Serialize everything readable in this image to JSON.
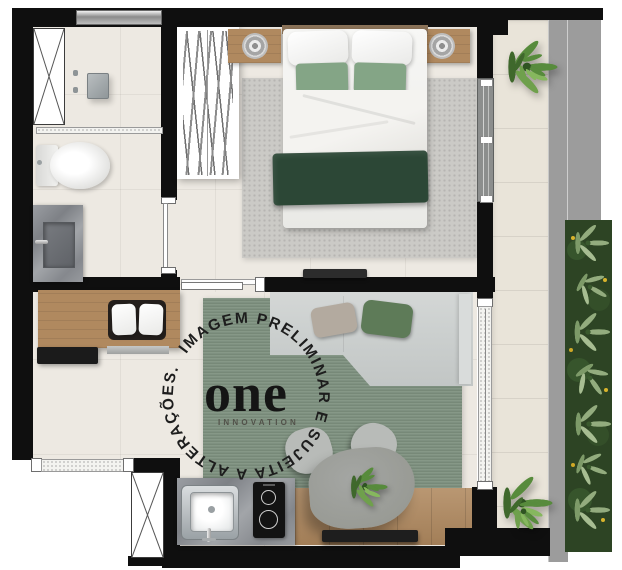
{
  "watermark": {
    "ring_text": "IMAGEM PRELIMINAR E SUJEITA A ALTERAÇÕES.",
    "logo_text": "one",
    "logo_subtext": "INNOVATION"
  },
  "palette": {
    "wall": "#0f0f0f",
    "floor_interior": "#ede9e2",
    "floor_balcony": "#e9e4d9",
    "walkway_gray": "#9c9c9c",
    "rug_bedroom": "#cbcac6",
    "rug_living": "#7d907e",
    "sofa_gray": "#ccd0cf",
    "bed_blanket_green": "#2c4736",
    "pillow_sage": "#84a586",
    "sofa_pillow_green": "#5e7b58",
    "sofa_pillow_taupe": "#b3aa9f",
    "wood": "#b0895f",
    "marble_gray": "#90939a",
    "vertical_garden_green": "#2d4424",
    "plant_green": "#4e7d36",
    "cooktop_black": "#131313",
    "watermark_text": "#1d1d1d"
  }
}
